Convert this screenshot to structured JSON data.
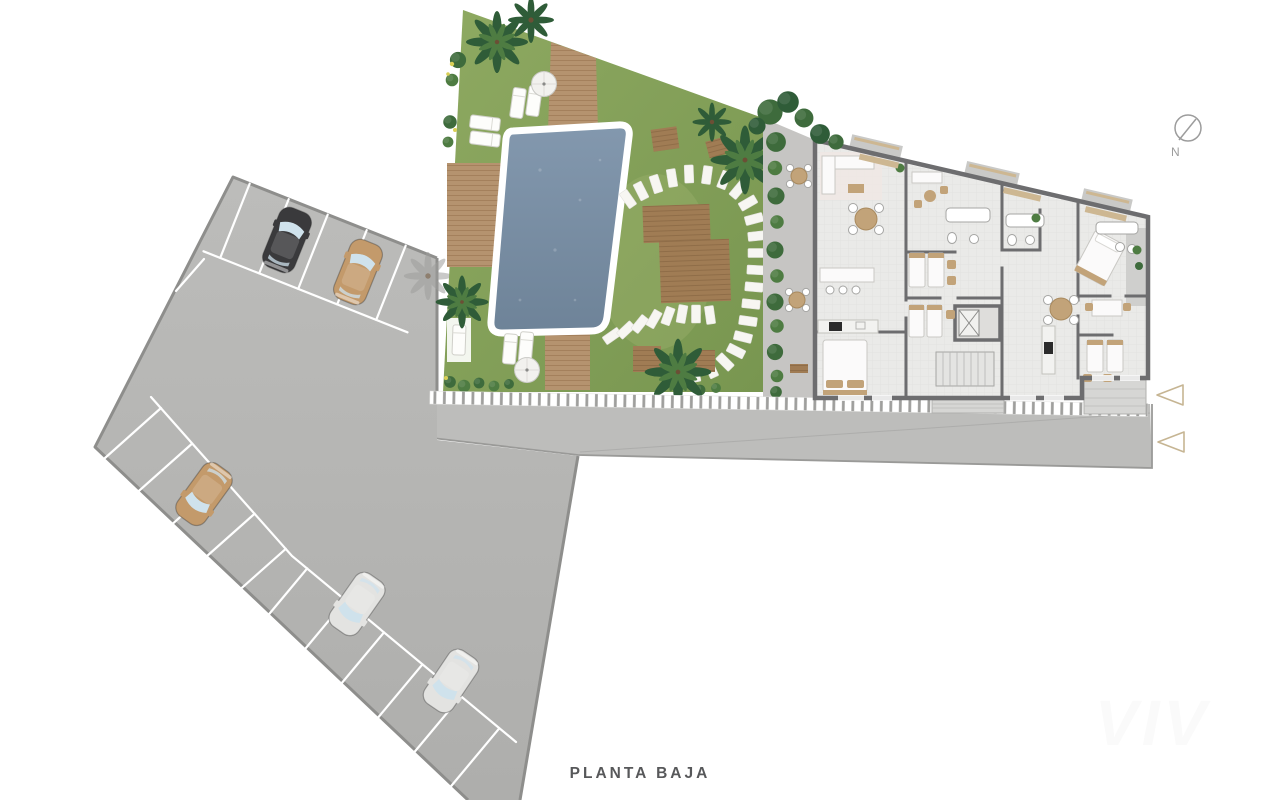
{
  "title": {
    "label": "PLANTA BAJA"
  },
  "compass": {
    "label": "N"
  },
  "watermark": {
    "label": "VIV"
  },
  "colors": {
    "page_bg": "#ffffff",
    "asphalt": "#b6b6b4",
    "road": "#bdbdbb",
    "asphalt_border": "#8e8e8c",
    "stall_line": "#ffffff",
    "lawn": "#86a25a",
    "palm": "#2f5c38",
    "palm_light": "#4e7c42",
    "hedge": "#3e6b3c",
    "wood": "#b5936f",
    "wood_dark": "#a07c54",
    "pool_water": "#7b90a7",
    "pool_border": "#ffffff",
    "stone": "#f7f6f2",
    "terrace": "#c6c5c3",
    "building_floor": "#eaeae8",
    "wall": "#6d6d6f",
    "furniture_white": "#fbfafa",
    "furniture_tan": "#c2a379",
    "fixture_stroke": "#a5a5a3",
    "stove": "#2b2b2b",
    "car_black": "#3a3a3c",
    "car_tan": "#c39a6b",
    "car_white": "#e3e3e1",
    "car_window": "#cfe2ec",
    "arrow_beige": "#c6b593",
    "stripe_tick": "#9f9f9d",
    "title_text": "#57585a",
    "compass_gray": "#9c9c9c",
    "accent_red": "#b03a30"
  },
  "plan": {
    "floor_label": "PLANTA BAJA",
    "areas": [
      {
        "id": "parking",
        "name": "parking-lot",
        "cars": [
          {
            "color": "black"
          },
          {
            "color": "tan"
          },
          {
            "color": "tan"
          },
          {
            "color": "white"
          },
          {
            "color": "white"
          }
        ]
      },
      {
        "id": "garden",
        "name": "pool-garden",
        "features": [
          "swimming-pool",
          "wood-deck",
          "sun-loungers",
          "parasols",
          "palm-trees",
          "stepping-stones",
          "wood-platforms",
          "planter"
        ]
      },
      {
        "id": "building",
        "name": "apartment-building",
        "features": [
          "living-rooms",
          "bedrooms",
          "bathrooms",
          "kitchens",
          "elevator-core",
          "stairs",
          "balconies",
          "terraces"
        ]
      },
      {
        "id": "road",
        "name": "access-road"
      }
    ],
    "entrance_arrows": 2
  }
}
